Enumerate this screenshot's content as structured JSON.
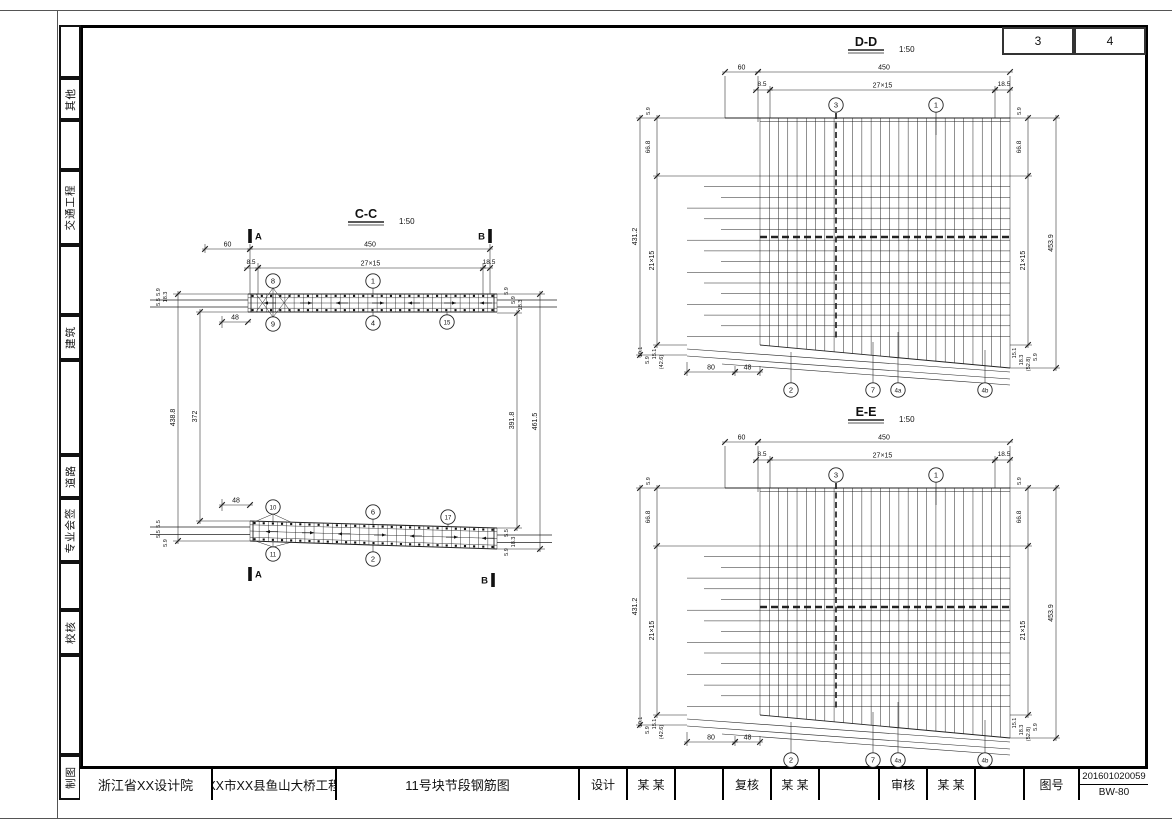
{
  "page": {
    "sheet_numbers": [
      "3",
      "4"
    ],
    "sidebar_labels": [
      "",
      "其他",
      "",
      "交通工程",
      "",
      "建筑",
      "",
      "道路",
      "专业会签",
      "",
      "校核",
      "",
      "制图"
    ],
    "title_block": {
      "institute": "浙江省XX设计院",
      "project": "XX市XX县鱼山大桥工程",
      "drawing_title": "11号块节段钢筋图",
      "design_label": "设计",
      "design_name": "某 某",
      "check_label": "复核",
      "check_name": "某 某",
      "audit_label": "审核",
      "audit_name": "某 某",
      "figno_label": "图号",
      "figno": "201601020059",
      "sheet_code": "BW-80"
    }
  },
  "drawings": {
    "cc": {
      "title": "C-C",
      "scale": "1:50",
      "dims": {
        "w60": "60",
        "w450": "450",
        "w85": "8.5",
        "w27x15": "27×15",
        "w185": "18.5",
        "w48": "48",
        "h438_8": "438.8",
        "h372": "372",
        "h391_8": "391.8",
        "h461_5": "461.5"
      },
      "small_dims": {
        "left_top": [
          "5.9",
          "5.5",
          "18.3"
        ],
        "left_bottom": [
          "5.5",
          "5.5",
          "5.9"
        ],
        "right_top": [
          "5.9",
          "5.9",
          "18.3"
        ],
        "right_bottom": [
          "5.5",
          "18.3",
          "5.9"
        ]
      },
      "markers": {
        "a": "A",
        "b": "B"
      },
      "callouts": {
        "top_above": [
          "8",
          "1"
        ],
        "top_below": [
          "9",
          "4",
          "15"
        ],
        "bottom_above": [
          "10",
          "6",
          "17"
        ],
        "bottom_below": [
          "11",
          "2"
        ]
      }
    },
    "dd": {
      "title": "D-D",
      "scale": "1:50",
      "dims": {
        "w60": "60",
        "w450": "450",
        "w85": "8.5",
        "w27x15": "27×15",
        "w185": "18.5",
        "w80": "80",
        "w48": "48",
        "h431_2": "431.2",
        "h21x15": "21×15",
        "h453_9": "453.9",
        "h66_8": "66.8",
        "h5_9": "5.9"
      },
      "small_left_bottom": [
        "10.1",
        "5.9",
        "15.1",
        "(42.6)"
      ],
      "small_right_bottom": [
        "15.1",
        "18.3",
        "(52.8)",
        "5.9"
      ],
      "callouts": {
        "top": [
          "3",
          "1"
        ],
        "bottom": [
          "2",
          "7",
          "4a",
          "4b"
        ]
      }
    },
    "ee": {
      "title": "E-E",
      "scale": "1:50",
      "dims": {
        "w60": "60",
        "w450": "450",
        "w85": "8.5",
        "w27x15": "27×15",
        "w185": "18.5",
        "w80": "80",
        "w48": "48",
        "h431_2": "431.2",
        "h21x15": "21×15",
        "h453_9": "453.9",
        "h66_8": "66.8",
        "h5_9": "5.9"
      },
      "small_left_bottom": [
        "10.1",
        "5.9",
        "15.1",
        "(42.6)"
      ],
      "small_right_bottom": [
        "15.1",
        "18.3",
        "(52.8)",
        "5.9"
      ],
      "callouts": {
        "top": [
          "3",
          "1"
        ],
        "bottom": [
          "2",
          "7",
          "4a",
          "4b"
        ]
      }
    }
  }
}
